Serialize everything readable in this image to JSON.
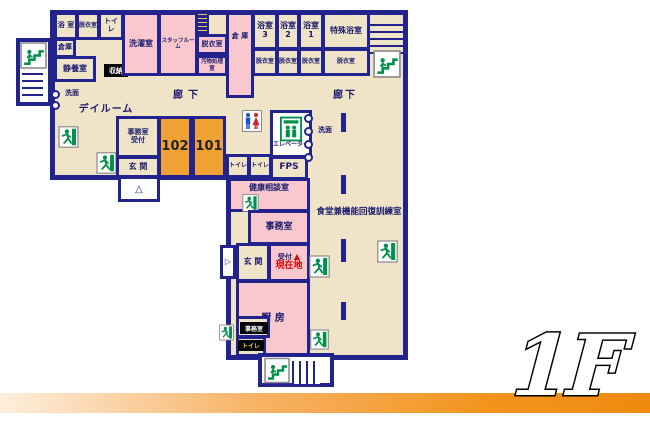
{
  "floor": {
    "label": "1F"
  },
  "corridors": {
    "left": "廊下",
    "right": "廊下"
  },
  "rooms": {
    "bath_tl": "浴 室",
    "changing_tl": "脱衣室",
    "toilet_tl": "トイレ",
    "storage_tl": "倉庫",
    "rest_room": "静養室",
    "closet": "収納",
    "laundry": "洗濯室",
    "staff_room": "スタッフルーム",
    "changing_mid": "脱衣室",
    "waste_room": "汚物処理室",
    "storage_tall": "倉 庫",
    "bath3": "浴室3",
    "bath2": "浴室2",
    "bath1": "浴室1",
    "special_bath": "特殊浴室",
    "changing_b3": "脱衣室",
    "changing_b2": "脱衣室",
    "changing_b1": "脱衣室",
    "changing_sp": "脱衣室",
    "day_room": "デイルーム",
    "washstand_left": "洗面",
    "office_front": "事務室",
    "reception_front": "受付",
    "entrance_front": "玄 関",
    "room_102": "102",
    "room_101": "101",
    "toilet_a": "トイレ",
    "toilet_b": "トイレ",
    "elevator": "エレベーター",
    "fps": "FPS",
    "washstand_center": "洗面",
    "health_consult": "健康相談室",
    "office_mid": "事務室",
    "entrance_main": "玄 関",
    "reception_main": "受付",
    "you_are_here": "現在地",
    "kitchen": "厨 房",
    "office_small": "事務室",
    "toilet_small": "トイレ",
    "dining_training": "食堂兼機能回復訓練室"
  },
  "markers": {
    "up_triangle": "△",
    "right_triangle": "▷",
    "here_triangle": "▲"
  },
  "icons": {
    "exit": "emergency-exit-running-man-icon",
    "stairs": "stairs-icon",
    "elevator": "elevator-icon",
    "toilet": "toilet-man-woman-icon",
    "sign": "small-vertical-sign-icon"
  },
  "colors": {
    "wall": "#23238e",
    "floor": "#f0e4c8",
    "room_pink": "#f9c8cf",
    "room_orange": "#efa233",
    "exit_green": "#00904a",
    "current_location_red": "#e60000",
    "bottom_bar_orange": "#f2941d"
  }
}
